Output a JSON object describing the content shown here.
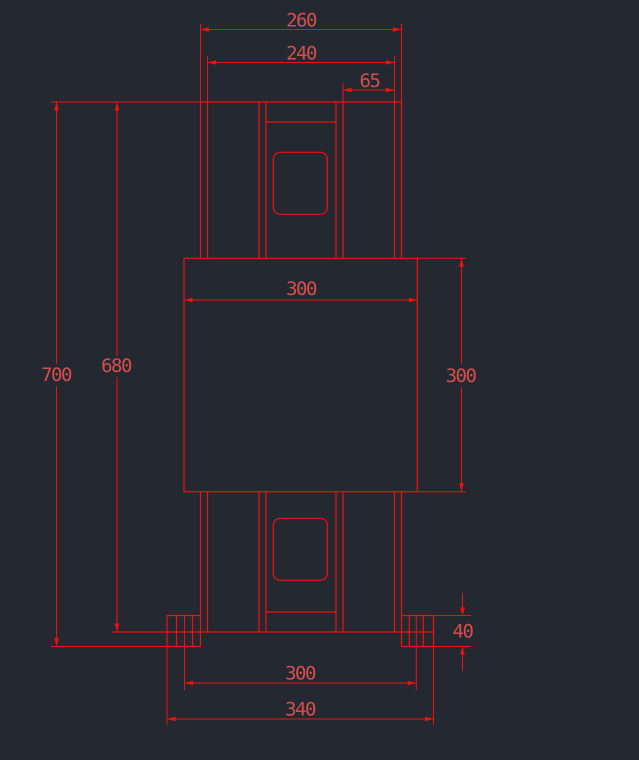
{
  "drawing": {
    "type": "cad-orthographic-front-view",
    "colors": {
      "background": "#242931",
      "line": "#f2100d",
      "dimension_text": "#d84c4c"
    },
    "dimensions": {
      "top_width_outer": "260",
      "top_width_inner": "240",
      "top_right_offset": "65",
      "overall_height": "700",
      "frame_height": "680",
      "core_width": "300",
      "core_height": "300",
      "foot_height": "40",
      "base_inner_width": "300",
      "base_outer_width": "340"
    }
  }
}
